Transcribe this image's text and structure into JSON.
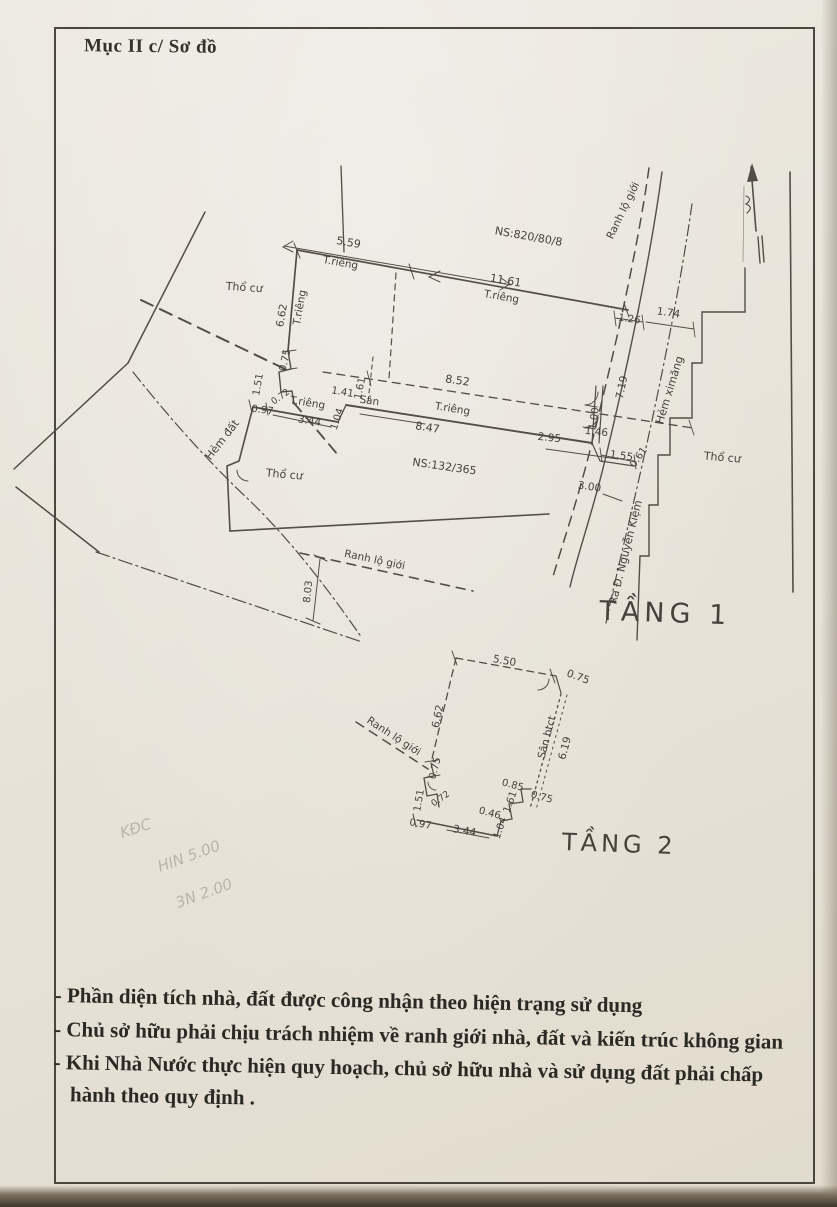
{
  "document": {
    "header": "Mục II c/ Sơ đồ",
    "notes": [
      "- Phần diện tích nhà, đất được công nhận theo hiện trạng sử dụng",
      "- Chủ sở hữu phải chịu trách nhiệm về ranh giới nhà, đất và kiến trúc không gian",
      "- Khi Nhà Nước  thực hiện quy hoạch, chủ sở hữu nhà và sử dụng đất phải chấp hành theo quy định ."
    ]
  },
  "common": {
    "t_rieng": "T.riêng",
    "tho_cu": "Thổ cư",
    "san": "Sân",
    "ranh_lo_gioi": "Ranh lộ giới"
  },
  "floor1": {
    "title": "TẦNG 1",
    "ns_upper": "NS:820/80/8",
    "ns_lower": "NS:132/365",
    "hem_dat": "Hẻm đất",
    "hem_ximang": "Hẻm ximăng",
    "ra_duong": "Ra Đ. Nguyễn Kiệm",
    "dims": {
      "d559": "5.59",
      "d1161": "11.61",
      "d662": "6.62",
      "d075": "0.75",
      "d151": "1.51",
      "d072": "0.72",
      "d097": "0.97",
      "d344": "3.44",
      "d104": "1.04",
      "d141": "1.41",
      "d161": "1.61",
      "d852": "8.52",
      "d847": "8.47",
      "d100": "1.00",
      "d061": "0.61",
      "d295": "2.95",
      "d146": "1.46",
      "d155": "1.55",
      "d300": "3.00",
      "d126": "1.26",
      "d174": "1.74",
      "d719": "7.19",
      "d803": "8.03"
    }
  },
  "floor2": {
    "title": "TẦNG 2",
    "san_btct": "Sân btct",
    "dims": {
      "d550": "5.50",
      "d075": "0.75",
      "d619": "6.19",
      "d662": "6.62",
      "d151": "1.51",
      "d072": "0.72",
      "d097": "0.97",
      "d344": "3.44",
      "d104": "1.04",
      "d046": "0.46",
      "d161": "1.61",
      "d085": "0.85"
    }
  },
  "handwriting": {
    "line1": "KĐC",
    "line2": "HIN 5.00",
    "line3": "3N 2.00"
  }
}
